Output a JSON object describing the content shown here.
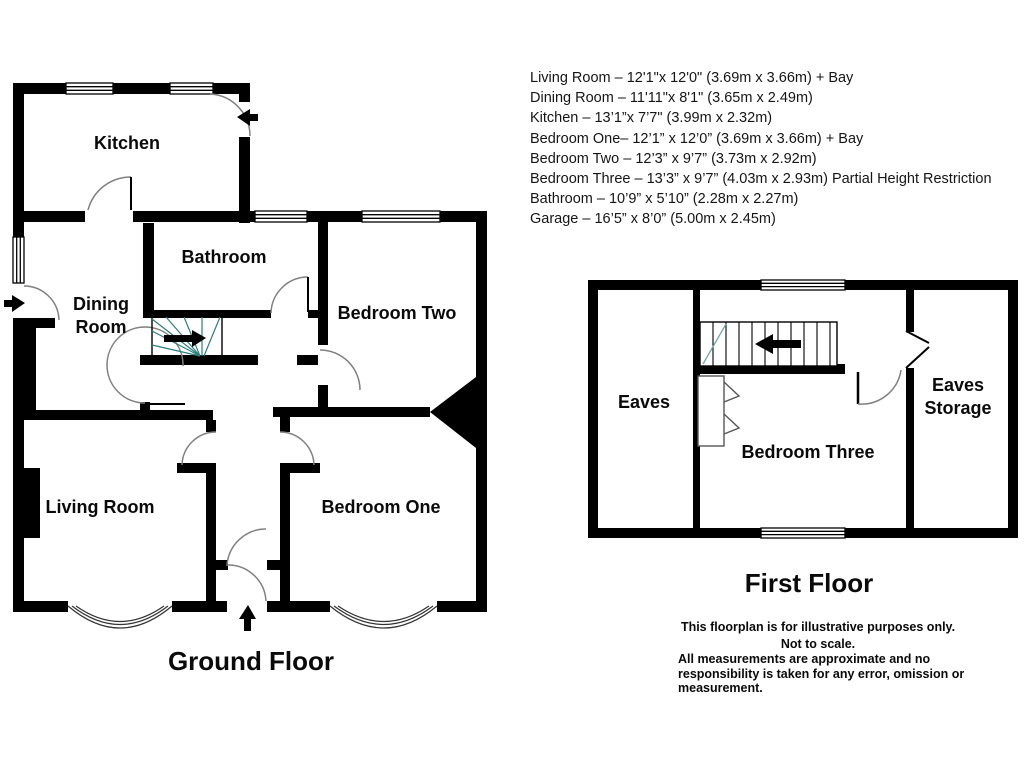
{
  "dimensions_list": {
    "lines": [
      "Living Room – 12'1\"x 12'0\" (3.69m x 3.66m) + Bay",
      "Dining Room – 11'11\"x 8'1\" (3.65m x 2.49m)",
      "Kitchen – 13’1”x 7’7\" (3.99m x 2.32m)",
      "Bedroom One– 12’1” x 12’0” (3.69m x 3.66m) + Bay",
      "Bedroom Two – 12’3” x 9’7” (3.73m x 2.92m)",
      "Bedroom Three – 13’3” x 9’7” (4.03m x 2.93m) Partial Height Restriction",
      "Bathroom – 10’9” x 5’10” (2.28m x 2.27m)",
      "Garage – 16’5” x 8’0” (5.00m x 2.45m)"
    ]
  },
  "ground_floor": {
    "title": "Ground Floor",
    "labels": {
      "kitchen": "Kitchen",
      "bathroom": "Bathroom",
      "bedroom_two": "Bedroom Two",
      "dining_line1": "Dining",
      "dining_line2": "Room",
      "living_room": "Living Room",
      "bedroom_one": "Bedroom One"
    }
  },
  "first_floor": {
    "title": "First Floor",
    "labels": {
      "eaves": "Eaves",
      "bedroom_three": "Bedroom Three",
      "eaves_storage_line1": "Eaves",
      "eaves_storage_line2": "Storage"
    }
  },
  "disclaimer": {
    "line1": "This floorplan is for illustrative purposes only.",
    "line2": "Not to scale.",
    "line3": "All measurements are approximate and no",
    "line4": "responsibility is taken for any error, omission or",
    "line5": "measurement."
  },
  "colors": {
    "walls": "#000000",
    "stairs_accent": "#2f7d7d",
    "first_floor_stairs_accent": "#74aaaa",
    "door_arc": "#808080",
    "background": "#ffffff"
  }
}
